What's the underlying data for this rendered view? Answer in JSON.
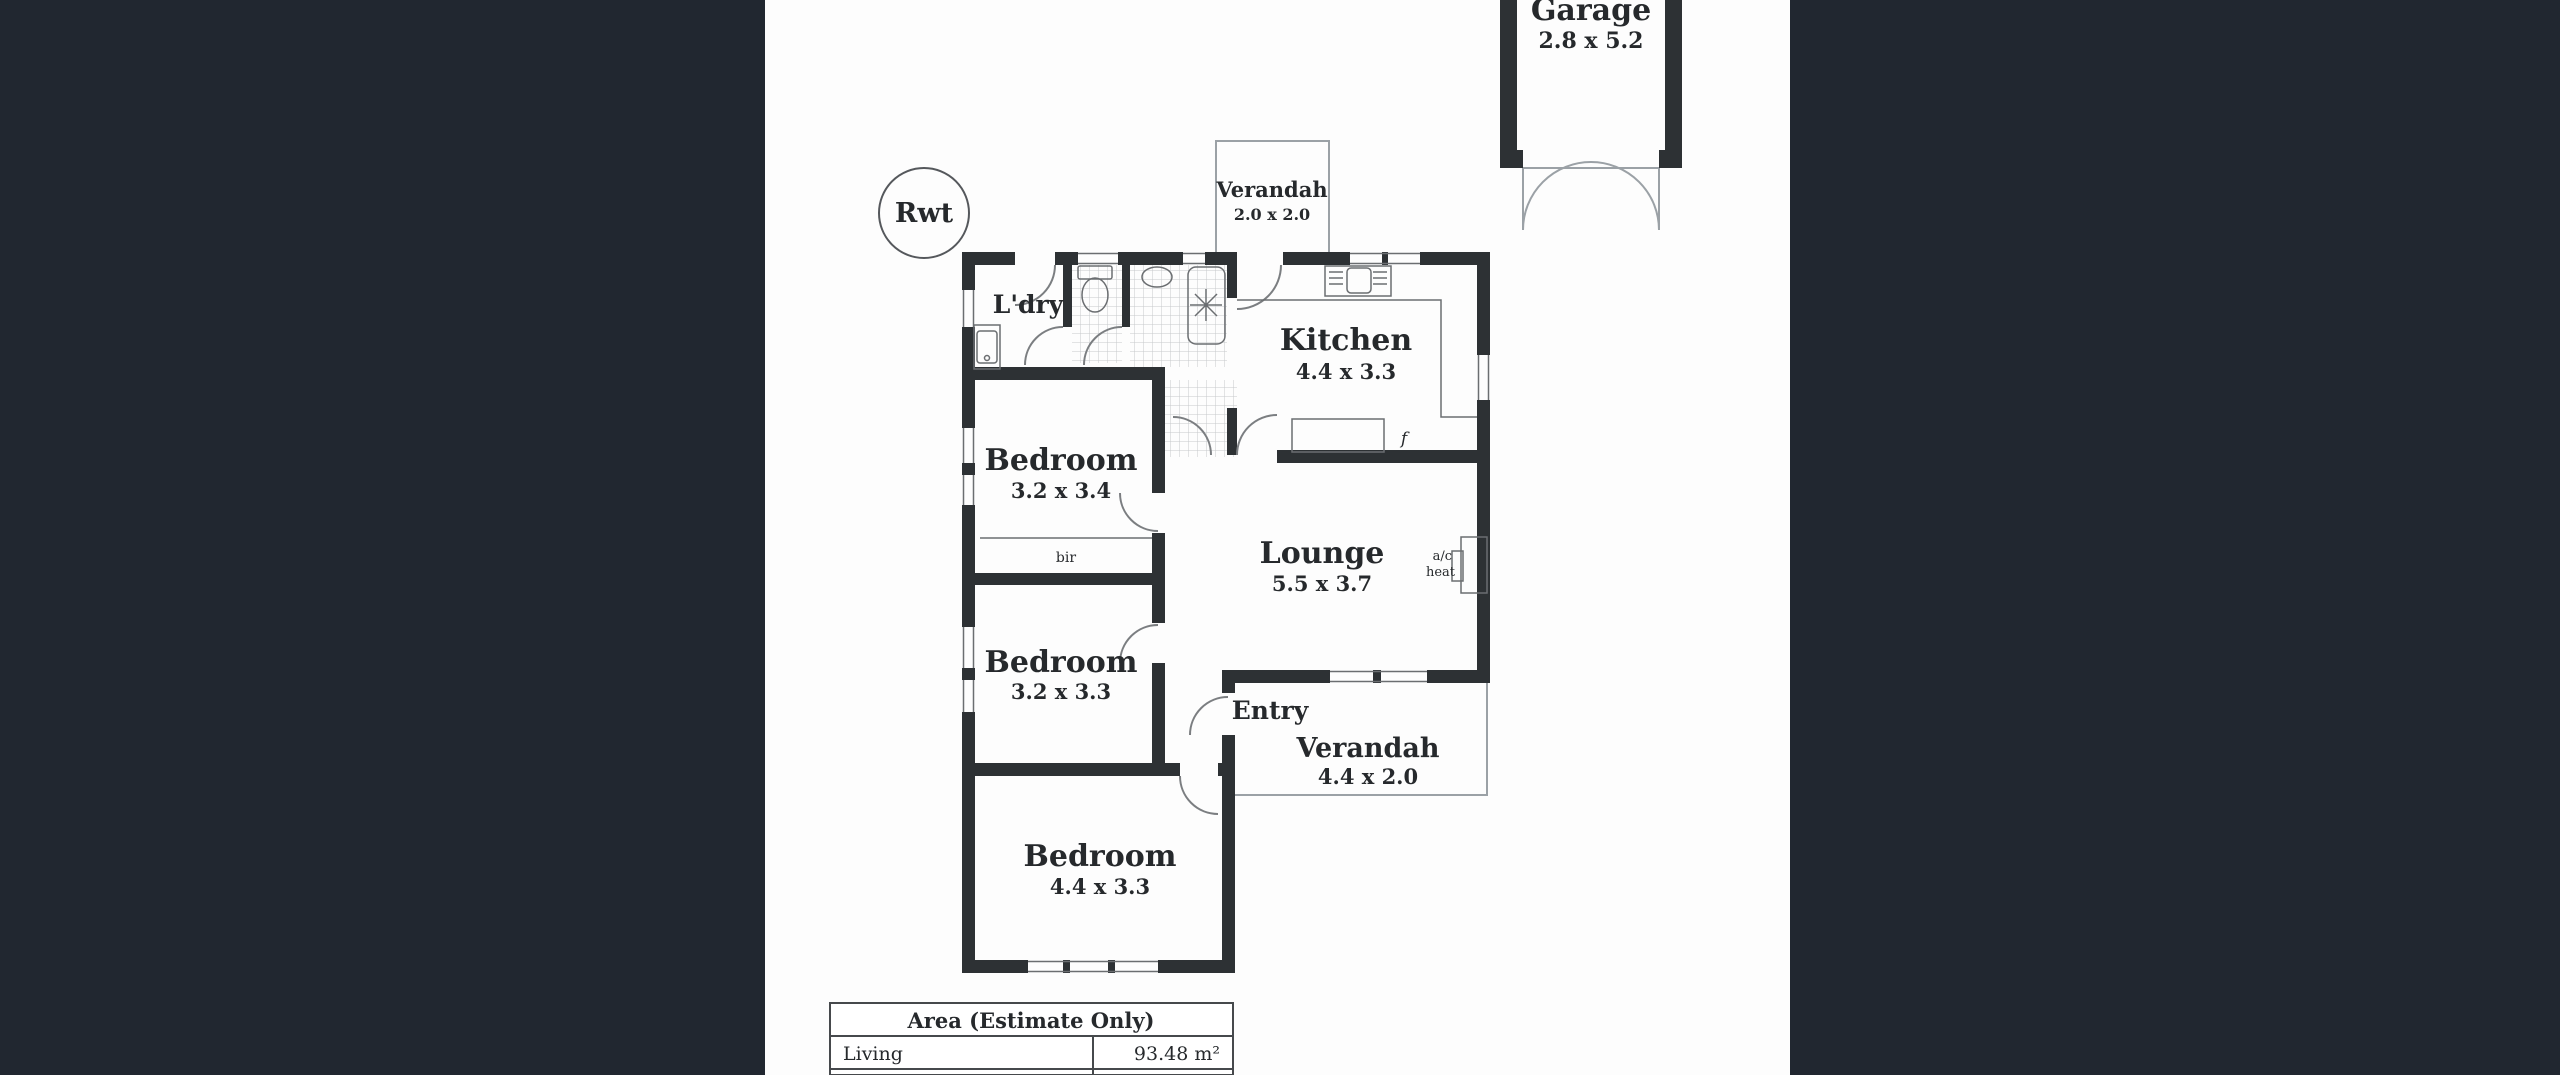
{
  "palette": {
    "side_panel": "#212730",
    "paper": "#fdfdfd",
    "wall": "#2d3134",
    "thin_line": "#6b6e71",
    "door_arc": "#7b7e81",
    "outline_gray": "#9ba1a6",
    "tile_grid": "#c6c9cc",
    "text": "#26292c"
  },
  "plan": {
    "rwt": "Rwt",
    "garage": {
      "name": "Garage",
      "dims": "2.8 x 5.2"
    },
    "verandah_top": {
      "name": "Verandah",
      "dims": "2.0 x 2.0"
    },
    "laundry": "L'dry",
    "kitchen": {
      "name": "Kitchen",
      "dims": "4.4 x 3.3"
    },
    "bedroom1": {
      "name": "Bedroom",
      "dims": "3.2 x 3.4"
    },
    "lounge": {
      "name": "Lounge",
      "dims": "5.5 x 3.7"
    },
    "bedroom2": {
      "name": "Bedroom",
      "dims": "3.2 x 3.3"
    },
    "entry": "Entry",
    "verandah_bottom": {
      "name": "Verandah",
      "dims": "4.4 x 2.0"
    },
    "bedroom3": {
      "name": "Bedroom",
      "dims": "4.4 x 3.3"
    },
    "bir": "bir",
    "fridge": "f",
    "ac": {
      "line1": "a/c",
      "line2": "heat"
    }
  },
  "area_table": {
    "header": "Area (Estimate Only)",
    "rows": [
      {
        "label": "Living",
        "value": "93.48 m²"
      }
    ]
  }
}
